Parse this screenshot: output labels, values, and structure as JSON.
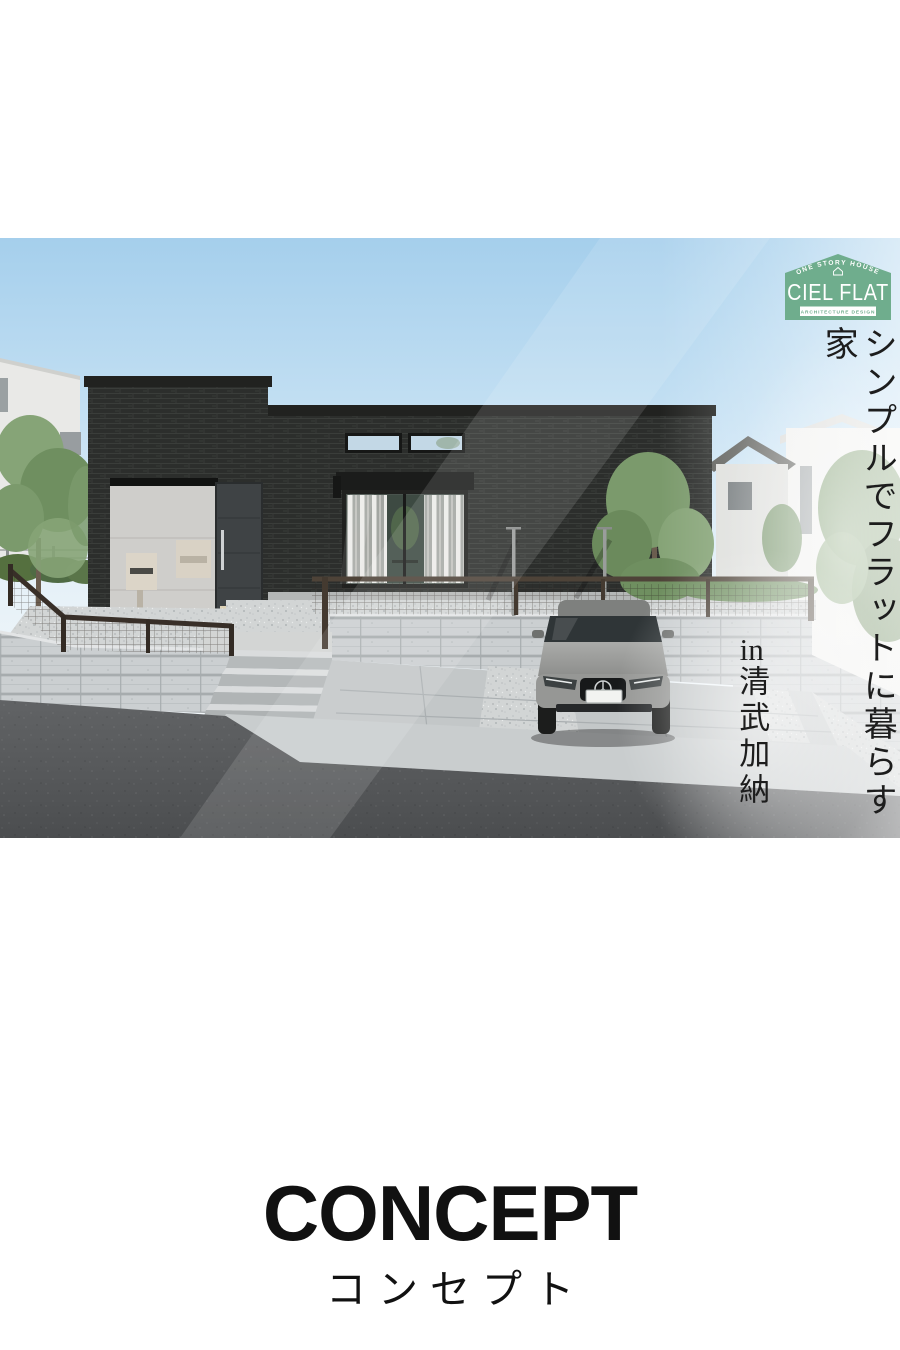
{
  "page": {
    "background": "#ffffff"
  },
  "hero": {
    "logo": {
      "arc_text": "ONE STORY HOUSE",
      "name": "CIEL FLAT",
      "sub_text": "ARCHITECTURE DESIGN",
      "green": "#6fad8d"
    },
    "catchphrase": "シンプルでフラットに暮らす家",
    "location_prefix": "in",
    "location_name": "清武加納",
    "text_color": "#1d1d1d"
  },
  "concept": {
    "title": "CONCEPT",
    "subtitle": "コンセプト",
    "color": "#111111"
  },
  "scene": {
    "description_colors": {
      "sky": "#a5cfec",
      "house_brick": "#2c2e2c",
      "block_wall": "#cbcfd1",
      "gravel": "#d2d5d5",
      "driveway": "#c3c7c8",
      "asphalt": "#595b5d",
      "railing": "#3a322c",
      "car_body": "#9fa09e",
      "background_house": "#ededeb",
      "tree_green": "#7b9a6c"
    }
  }
}
